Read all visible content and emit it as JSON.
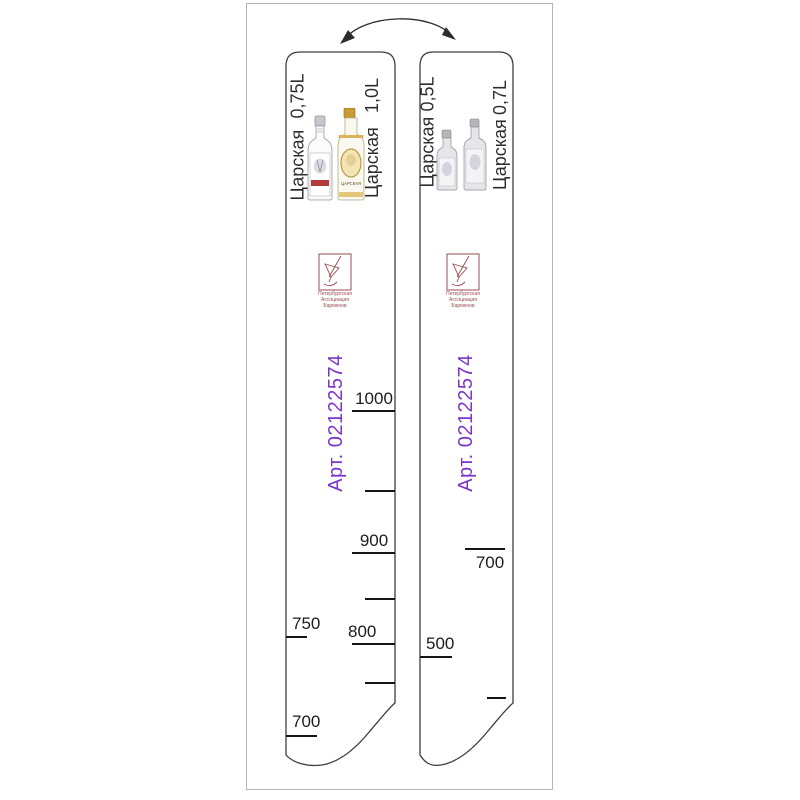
{
  "colors": {
    "article": "#7c35c7",
    "logo": "#9b4b52",
    "tick": "#151515",
    "outline": "#3f3f3f"
  },
  "icons": {
    "flip_arrow": "curved-double-headed-arrow",
    "logo": "cocktail-glass-in-square",
    "bottles_left_strip": [
      "vodka-bottle-white-label-0.75l",
      "vodka-bottle-gold-label-1l"
    ],
    "bottles_right_strip": [
      "vodka-bottle-clear-0.5l",
      "vodka-bottle-clear-0.7l"
    ]
  },
  "strips": [
    {
      "header_labels": [
        {
          "brand": "Царская",
          "volume": "0,75L"
        },
        {
          "brand": "Царская",
          "volume": "1,0L"
        }
      ],
      "bottle_label": "ЦАРСКАЯ",
      "logo_lines": [
        "Петербургская",
        "Ассоциация",
        "Барменов"
      ],
      "article": "Арт. 02122574",
      "scale_left": {
        "labels": [
          "750",
          "700"
        ]
      },
      "scale_right": {
        "labels": [
          "1000",
          "900",
          "800"
        ]
      }
    },
    {
      "header_labels": [
        {
          "brand": "Царская",
          "volume": "0,5L"
        },
        {
          "brand": "Царская",
          "volume": "0,7L"
        }
      ],
      "logo_lines": [
        "Петербургская",
        "Ассоциация",
        "Барменов"
      ],
      "article": "Арт. 02122574",
      "scale_left": {
        "labels": [
          "500"
        ]
      },
      "scale_right": {
        "labels": [
          "700"
        ]
      }
    }
  ]
}
